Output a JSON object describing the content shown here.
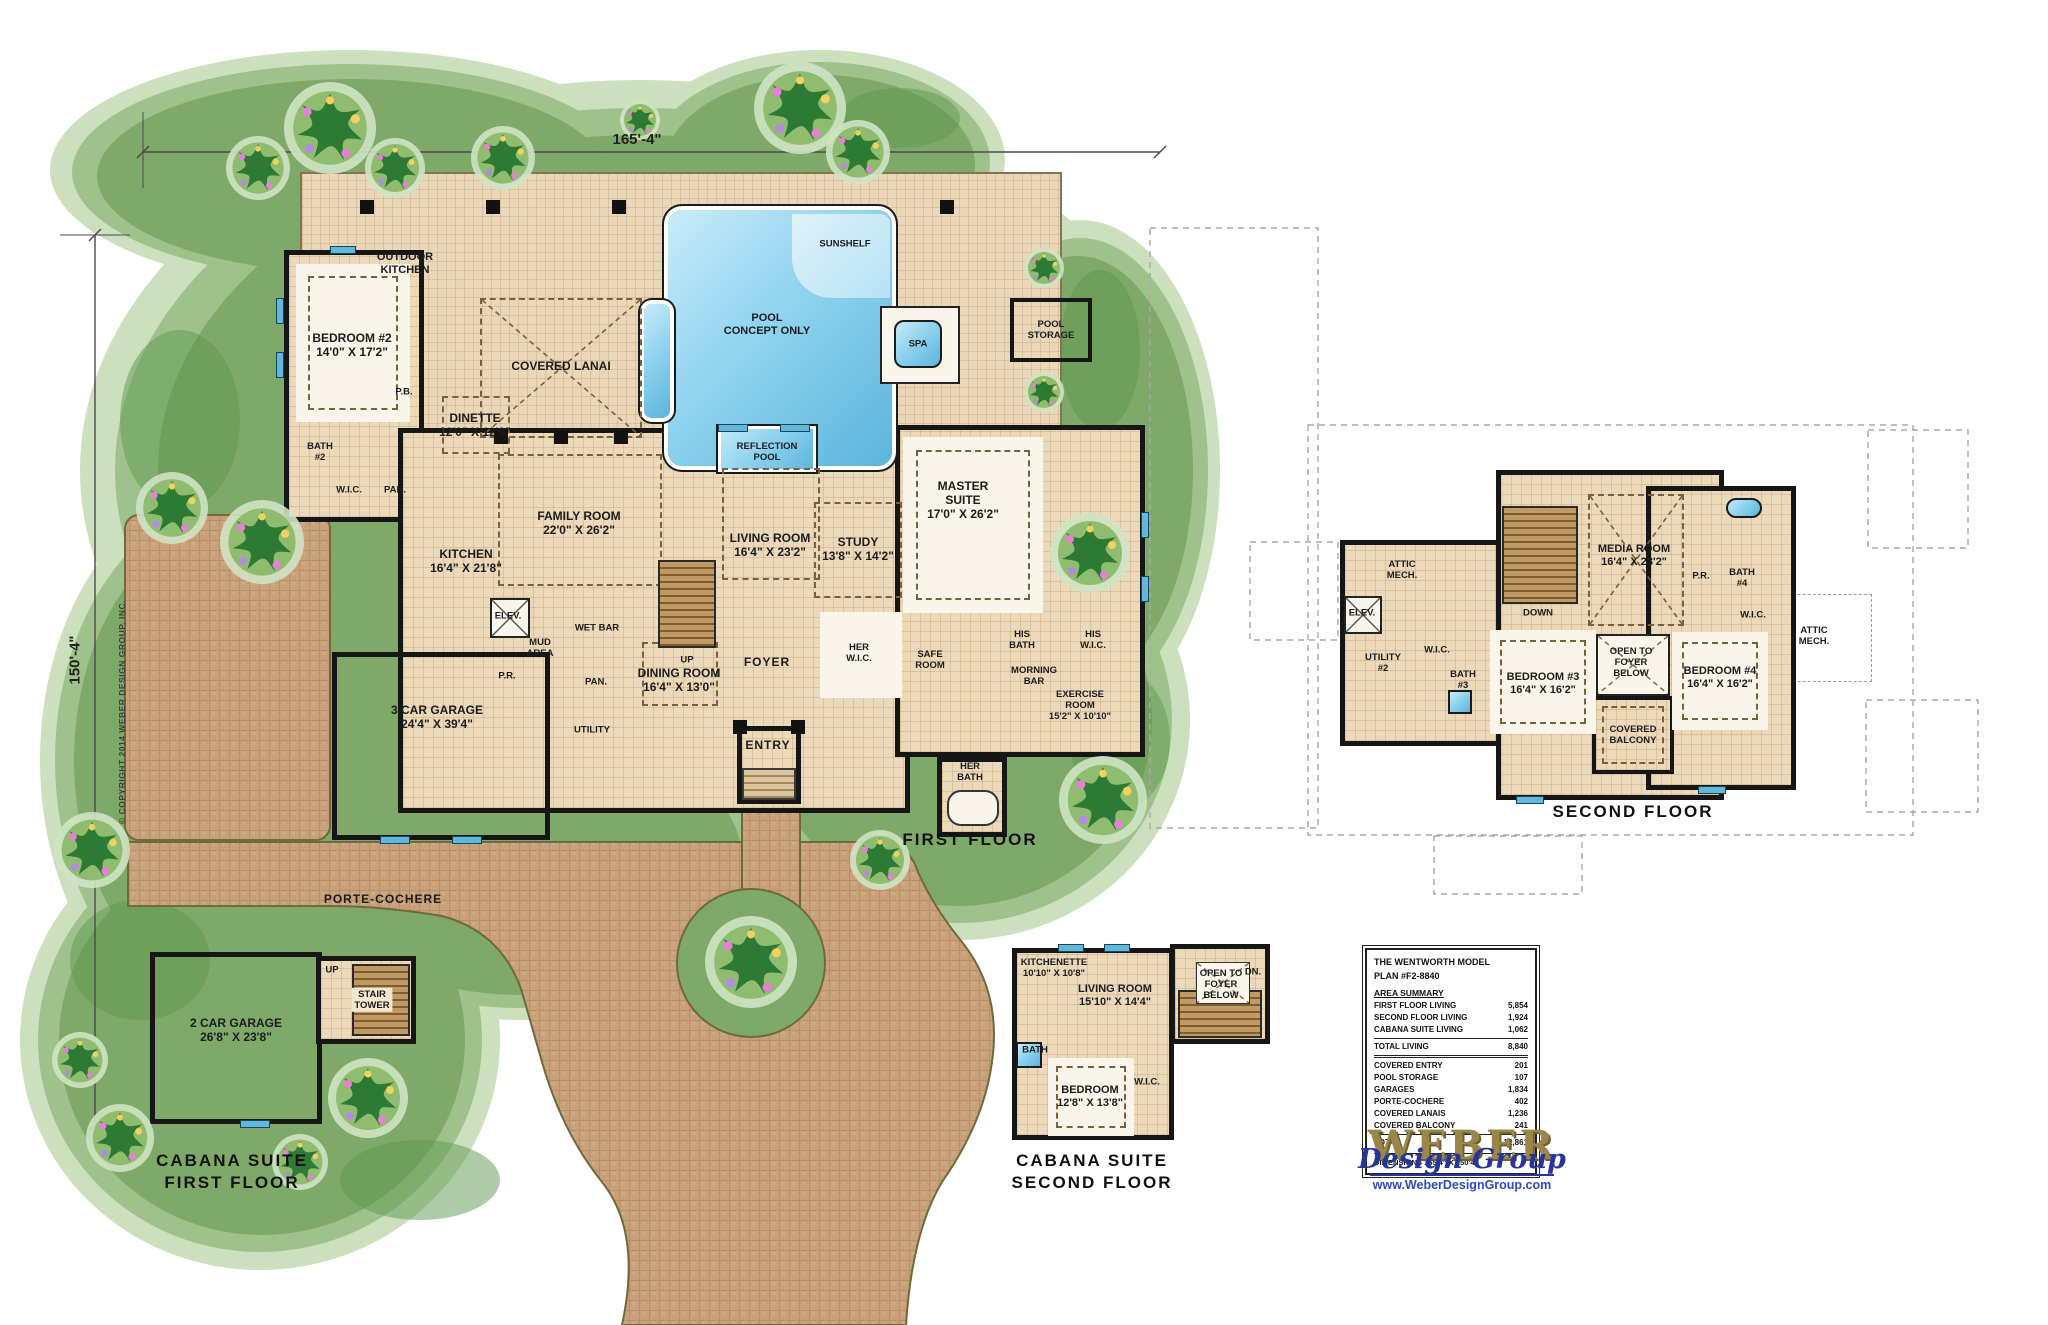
{
  "dims": {
    "top": "165'-4\"",
    "left": "150'-4\""
  },
  "copyright": "© COPYRIGHT 2014 WEBER DESIGN GROUP, INC.",
  "ff": {
    "caption": [
      "FIRST FLOOR"
    ],
    "outdoor_kitchen": [
      "OUTDOOR",
      "KITCHEN"
    ],
    "bedroom2": [
      "BEDROOM #2",
      "14'0\" X 17'2\""
    ],
    "bath2": [
      "BATH",
      "#2"
    ],
    "wic": [
      "W.I.C."
    ],
    "pan1": [
      "PAN."
    ],
    "pb": [
      "P.B."
    ],
    "dinette": [
      "DINETTE",
      "12'0\" X 12'0\""
    ],
    "lanai": [
      "COVERED LANAI"
    ],
    "pool": [
      "POOL",
      "CONCEPT ONLY"
    ],
    "sunshelf": [
      "SUNSHELF"
    ],
    "spa": [
      "SPA"
    ],
    "storage": [
      "POOL",
      "STORAGE"
    ],
    "reflection": [
      "REFLECTION",
      "POOL"
    ],
    "family": [
      "FAMILY ROOM",
      "22'0\" X 26'2\""
    ],
    "kitchen": [
      "KITCHEN",
      "16'4\" X 21'8\""
    ],
    "living": [
      "LIVING ROOM",
      "16'4\" X 23'2\""
    ],
    "up": [
      "UP"
    ],
    "study": [
      "STUDY",
      "13'8\" X 14'2\""
    ],
    "master": [
      "MASTER",
      "SUITE",
      "17'0\" X 26'2\""
    ],
    "hisbath": [
      "HIS",
      "BATH"
    ],
    "hiswic": [
      "HIS",
      "W.I.C."
    ],
    "elev": [
      "ELEV."
    ],
    "mud": [
      "MUD",
      "AREA"
    ],
    "pr": [
      "P.R."
    ],
    "wetbar": [
      "WET BAR"
    ],
    "pan2": [
      "PAN."
    ],
    "dining": [
      "DINING ROOM",
      "16'4\" X 13'0\""
    ],
    "foyer": [
      "FOYER"
    ],
    "herwic": [
      "HER",
      "W.I.C."
    ],
    "safe": [
      "SAFE",
      "ROOM"
    ],
    "morning": [
      "MORNING",
      "BAR"
    ],
    "exercise": [
      "EXERCISE",
      "ROOM",
      "15'2\" X 10'10\""
    ],
    "herbath": [
      "HER",
      "BATH"
    ],
    "garage": [
      "3 CAR GARAGE",
      "24'4\" X 39'4\""
    ],
    "utility": [
      "UTILITY"
    ],
    "entry": [
      "ENTRY"
    ],
    "porte": [
      "PORTE-COCHERE"
    ]
  },
  "sf": {
    "caption": [
      "SECOND FLOOR"
    ],
    "attic1": [
      "ATTIC",
      "MECH."
    ],
    "elev": [
      "ELEV."
    ],
    "down": [
      "DOWN"
    ],
    "utility2": [
      "UTILITY",
      "#2"
    ],
    "wic1": [
      "W.I.C."
    ],
    "bath3": [
      "BATH",
      "#3"
    ],
    "br3": [
      "BEDROOM #3",
      "16'4\" X 16'2\""
    ],
    "media": [
      "MEDIA ROOM",
      "16'4\" X 23'2\""
    ],
    "pr": [
      "P.R."
    ],
    "bath4": [
      "BATH",
      "#4"
    ],
    "wic2": [
      "W.I.C."
    ],
    "attic2": [
      "ATTIC",
      "MECH."
    ],
    "open": [
      "OPEN TO",
      "FOYER",
      "BELOW"
    ],
    "br4": [
      "BEDROOM #4",
      "16'4\" X 16'2\""
    ],
    "balcony": [
      "COVERED",
      "BALCONY"
    ]
  },
  "c1": {
    "caption": [
      "CABANA SUITE",
      "FIRST FLOOR"
    ],
    "up": [
      "UP"
    ],
    "tower": [
      "STAIR",
      "TOWER"
    ],
    "garage": [
      "2 CAR GARAGE",
      "26'8\" X 23'8\""
    ]
  },
  "c2": {
    "caption": [
      "CABANA SUITE",
      "SECOND FLOOR"
    ],
    "kitchenette": [
      "KITCHENETTE",
      "10'10\" X 10'8\""
    ],
    "living": [
      "LIVING ROOM",
      "15'10\" X 14'4\""
    ],
    "dn": [
      "DN."
    ],
    "open": [
      "OPEN TO",
      "FOYER",
      "BELOW"
    ],
    "bath": [
      "BATH"
    ],
    "wic": [
      "W.I.C."
    ],
    "bedroom": [
      "BEDROOM",
      "12'8\" X 13'8\""
    ]
  },
  "table": {
    "title": [
      "THE WENTWORTH MODEL",
      "PLAN #F2-8840"
    ],
    "section": "AREA SUMMARY",
    "rows1": [
      [
        "FIRST FLOOR LIVING",
        "5,854"
      ],
      [
        "SECOND FLOOR LIVING",
        "1,924"
      ],
      [
        "CABANA SUITE LIVING",
        "1,062"
      ]
    ],
    "total1": [
      "TOTAL LIVING",
      "8,840"
    ],
    "rows2": [
      [
        "COVERED ENTRY",
        "201"
      ],
      [
        "POOL STORAGE",
        "107"
      ],
      [
        "GARAGES",
        "1,834"
      ],
      [
        "PORTE-COCHERE",
        "402"
      ],
      [
        "COVERED LANAIS",
        "1,236"
      ],
      [
        "COVERED BALCONY",
        "241"
      ]
    ],
    "total2": [
      "TOTAL",
      "12,861"
    ],
    "dims": "DIMENSIONS 165'4\" X 150'4\""
  },
  "logo": {
    "word": "WEBER",
    "script": "Design Group",
    "url": "www.WeberDesignGroup.com"
  }
}
